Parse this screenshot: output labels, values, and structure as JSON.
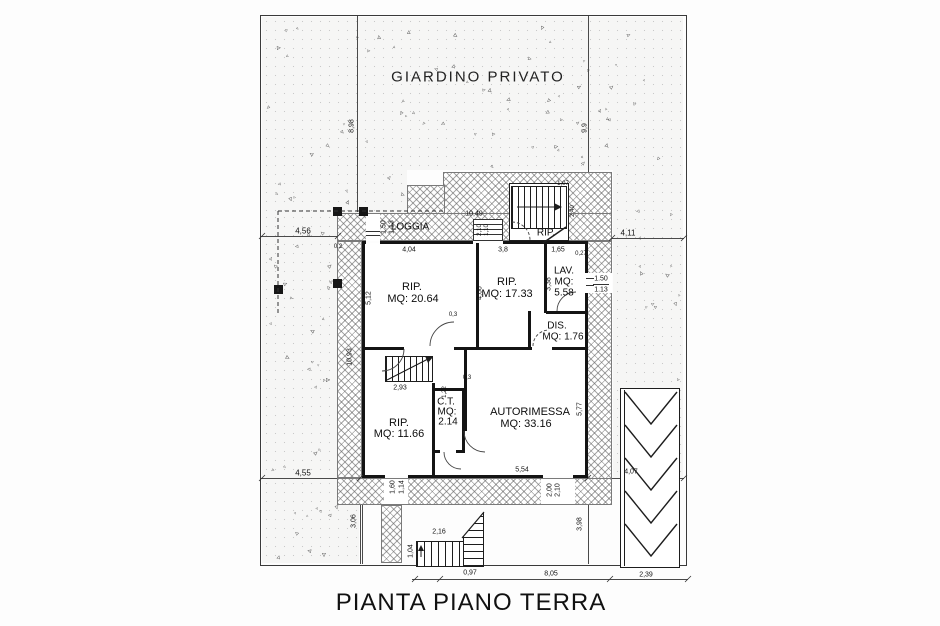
{
  "title": "PIANTA PIANO TERRA",
  "garden_label": "GIARDINO PRIVATO",
  "rooms": {
    "loggia": {
      "name": "LOGGIA"
    },
    "rip_scala": {
      "name": "RIP."
    },
    "rip1": {
      "name": "RIP.",
      "area": "MQ: 20.64"
    },
    "rip2": {
      "name": "RIP.",
      "area": "MQ: 17.33"
    },
    "lav": {
      "name": "LAV.",
      "mq": "MQ:",
      "area": "5.58"
    },
    "dis": {
      "name": "DIS.",
      "area": "MQ: 1.76"
    },
    "rip3": {
      "name": "RIP.",
      "area": "MQ: 11.66"
    },
    "ct": {
      "name": "C.T.",
      "mq": "MQ:",
      "area": "2.14"
    },
    "autorimessa": {
      "name": "AUTORIMESSA",
      "area": "MQ: 33.16"
    }
  },
  "window_lav": {
    "top": "1.50",
    "bottom": "1.13"
  },
  "dimensions": [
    {
      "t": "4,56",
      "x": 303,
      "y": 231,
      "r": 0,
      "s": 8
    },
    {
      "t": "4,11",
      "x": 628,
      "y": 233,
      "r": 0,
      "s": 8
    },
    {
      "t": "8,98",
      "x": 352,
      "y": 126,
      "r": 1,
      "s": 7
    },
    {
      "t": "9,9",
      "x": 585,
      "y": 128,
      "r": 1,
      "s": 7
    },
    {
      "t": "4,55",
      "x": 303,
      "y": 473,
      "r": 0,
      "s": 8
    },
    {
      "t": "3,06",
      "x": 354,
      "y": 521,
      "r": 1,
      "s": 7
    },
    {
      "t": "3,98",
      "x": 580,
      "y": 524,
      "r": 1,
      "s": 7
    },
    {
      "t": "4,07",
      "x": 631,
      "y": 472,
      "r": 0,
      "s": 7
    },
    {
      "t": "10,49",
      "x": 474,
      "y": 214,
      "r": 0,
      "s": 7
    },
    {
      "t": "1,50",
      "x": 384,
      "y": 227,
      "r": 1,
      "s": 7
    },
    {
      "t": "1,13",
      "x": 392,
      "y": 227,
      "r": 1,
      "s": 7
    },
    {
      "t": "2,10",
      "x": 480,
      "y": 230,
      "r": 1,
      "s": 6
    },
    {
      "t": "1,10",
      "x": 487,
      "y": 230,
      "r": 1,
      "s": 6
    },
    {
      "t": "1,07",
      "x": 563,
      "y": 184,
      "r": 0,
      "s": 6
    },
    {
      "t": "2,40",
      "x": 573,
      "y": 211,
      "r": 1,
      "s": 6
    },
    {
      "t": "4,04",
      "x": 409,
      "y": 250,
      "r": 0,
      "s": 7
    },
    {
      "t": "3,8",
      "x": 503,
      "y": 250,
      "r": 0,
      "s": 7
    },
    {
      "t": "1,65",
      "x": 558,
      "y": 250,
      "r": 0,
      "s": 7
    },
    {
      "t": "0,27",
      "x": 581,
      "y": 254,
      "r": 0,
      "s": 6
    },
    {
      "t": "0,2",
      "x": 338,
      "y": 247,
      "r": 0,
      "s": 6
    },
    {
      "t": "5,12",
      "x": 369,
      "y": 298,
      "r": 1,
      "s": 7
    },
    {
      "t": "4,66",
      "x": 480,
      "y": 293,
      "r": 1,
      "s": 7
    },
    {
      "t": "3,38",
      "x": 549,
      "y": 284,
      "r": 1,
      "s": 7
    },
    {
      "t": "0,3",
      "x": 453,
      "y": 315,
      "r": 0,
      "s": 6
    },
    {
      "t": "0,3",
      "x": 467,
      "y": 378,
      "r": 0,
      "s": 6
    },
    {
      "t": "10,93",
      "x": 350,
      "y": 357,
      "r": 1,
      "s": 7
    },
    {
      "t": "1,22",
      "x": 445,
      "y": 392,
      "r": 1,
      "s": 6
    },
    {
      "t": "2,93",
      "x": 400,
      "y": 388,
      "r": 0,
      "s": 7
    },
    {
      "t": "5,77",
      "x": 580,
      "y": 409,
      "r": 1,
      "s": 7
    },
    {
      "t": "5,54",
      "x": 522,
      "y": 470,
      "r": 0,
      "s": 7
    },
    {
      "t": "1,60",
      "x": 393,
      "y": 487,
      "r": 1,
      "s": 7
    },
    {
      "t": "1,14",
      "x": 402,
      "y": 487,
      "r": 1,
      "s": 7
    },
    {
      "t": "2,00",
      "x": 550,
      "y": 490,
      "r": 1,
      "s": 7
    },
    {
      "t": "2,10",
      "x": 558,
      "y": 490,
      "r": 1,
      "s": 7
    },
    {
      "t": "2,16",
      "x": 439,
      "y": 532,
      "r": 0,
      "s": 7
    },
    {
      "t": "1,04",
      "x": 411,
      "y": 551,
      "r": 1,
      "s": 7
    },
    {
      "t": "0,97",
      "x": 470,
      "y": 573,
      "r": 0,
      "s": 7
    },
    {
      "t": "8,05",
      "x": 551,
      "y": 574,
      "r": 0,
      "s": 7
    },
    {
      "t": "2,39",
      "x": 646,
      "y": 575,
      "r": 0,
      "s": 7
    }
  ]
}
